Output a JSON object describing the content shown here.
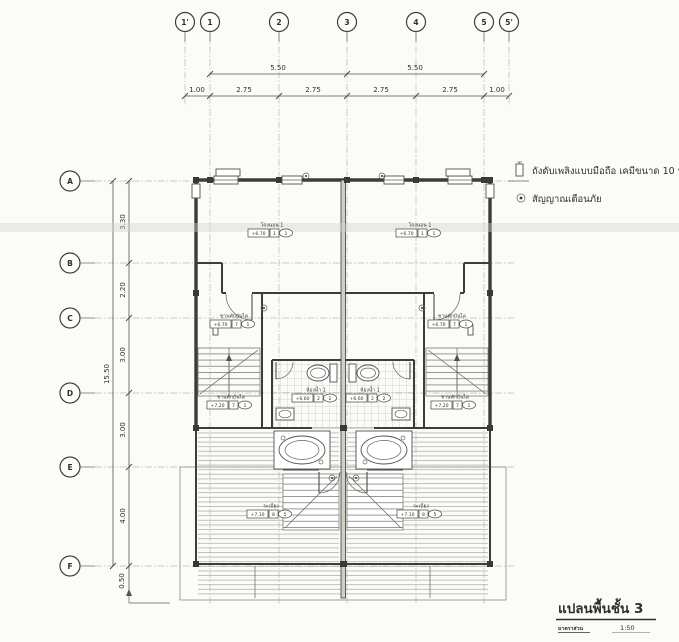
{
  "legend": {
    "extinguisher_text": "ถังดับเพลิงแบบมือถือ เคมีขนาด 10 ป",
    "alarm_text": "สัญญาณเตือนภัย"
  },
  "titleblock": {
    "title": "แปลนพื้นชั้น 3",
    "scale_label": "มาตราส่วน",
    "scale_value": "1:50"
  },
  "grid": {
    "cols": [
      "1'",
      "1",
      "2",
      "3",
      "4",
      "5",
      "5'"
    ],
    "rows": [
      "A",
      "B",
      "C",
      "D",
      "E",
      "F"
    ]
  },
  "dims": {
    "top_major": [
      "5.50",
      "5.50"
    ],
    "top_minor": [
      "1.00",
      "2.75",
      "2.75",
      "2.75",
      "2.75",
      "1.00"
    ],
    "left_total": "15.50",
    "left_segs": [
      "3.30",
      "2.20",
      "3.00",
      "3.00",
      "4.00"
    ],
    "below_f": "0.50"
  },
  "rooms": [
    {
      "name": "โถงนอน 1",
      "level": "+6.70",
      "floor": "1",
      "circ": "1"
    },
    {
      "name": "โถงนอน 1",
      "level": "+6.70",
      "floor": "1",
      "circ": "1"
    },
    {
      "name": "ชานพักบันได",
      "level": "+6.70",
      "floor": "7",
      "circ": "1"
    },
    {
      "name": "ชานพักบันได",
      "level": "+6.70",
      "floor": "7",
      "circ": "1"
    },
    {
      "name": "ห้องน้ำ 1",
      "level": "+6.60",
      "floor": "2",
      "circ": "2"
    },
    {
      "name": "ห้องน้ำ 1",
      "level": "+6.60",
      "floor": "2",
      "circ": "2"
    },
    {
      "name": "ชานพักบันได",
      "level": "+7.20",
      "floor": "7",
      "circ": "1"
    },
    {
      "name": "ชานพักบันได",
      "level": "+7.20",
      "floor": "7",
      "circ": "1"
    },
    {
      "name": "ระเบียง",
      "level": "+7.10",
      "floor": "8",
      "circ": "5"
    },
    {
      "name": "ระเบียง",
      "level": "+7.10",
      "floor": "8",
      "circ": "5"
    }
  ]
}
